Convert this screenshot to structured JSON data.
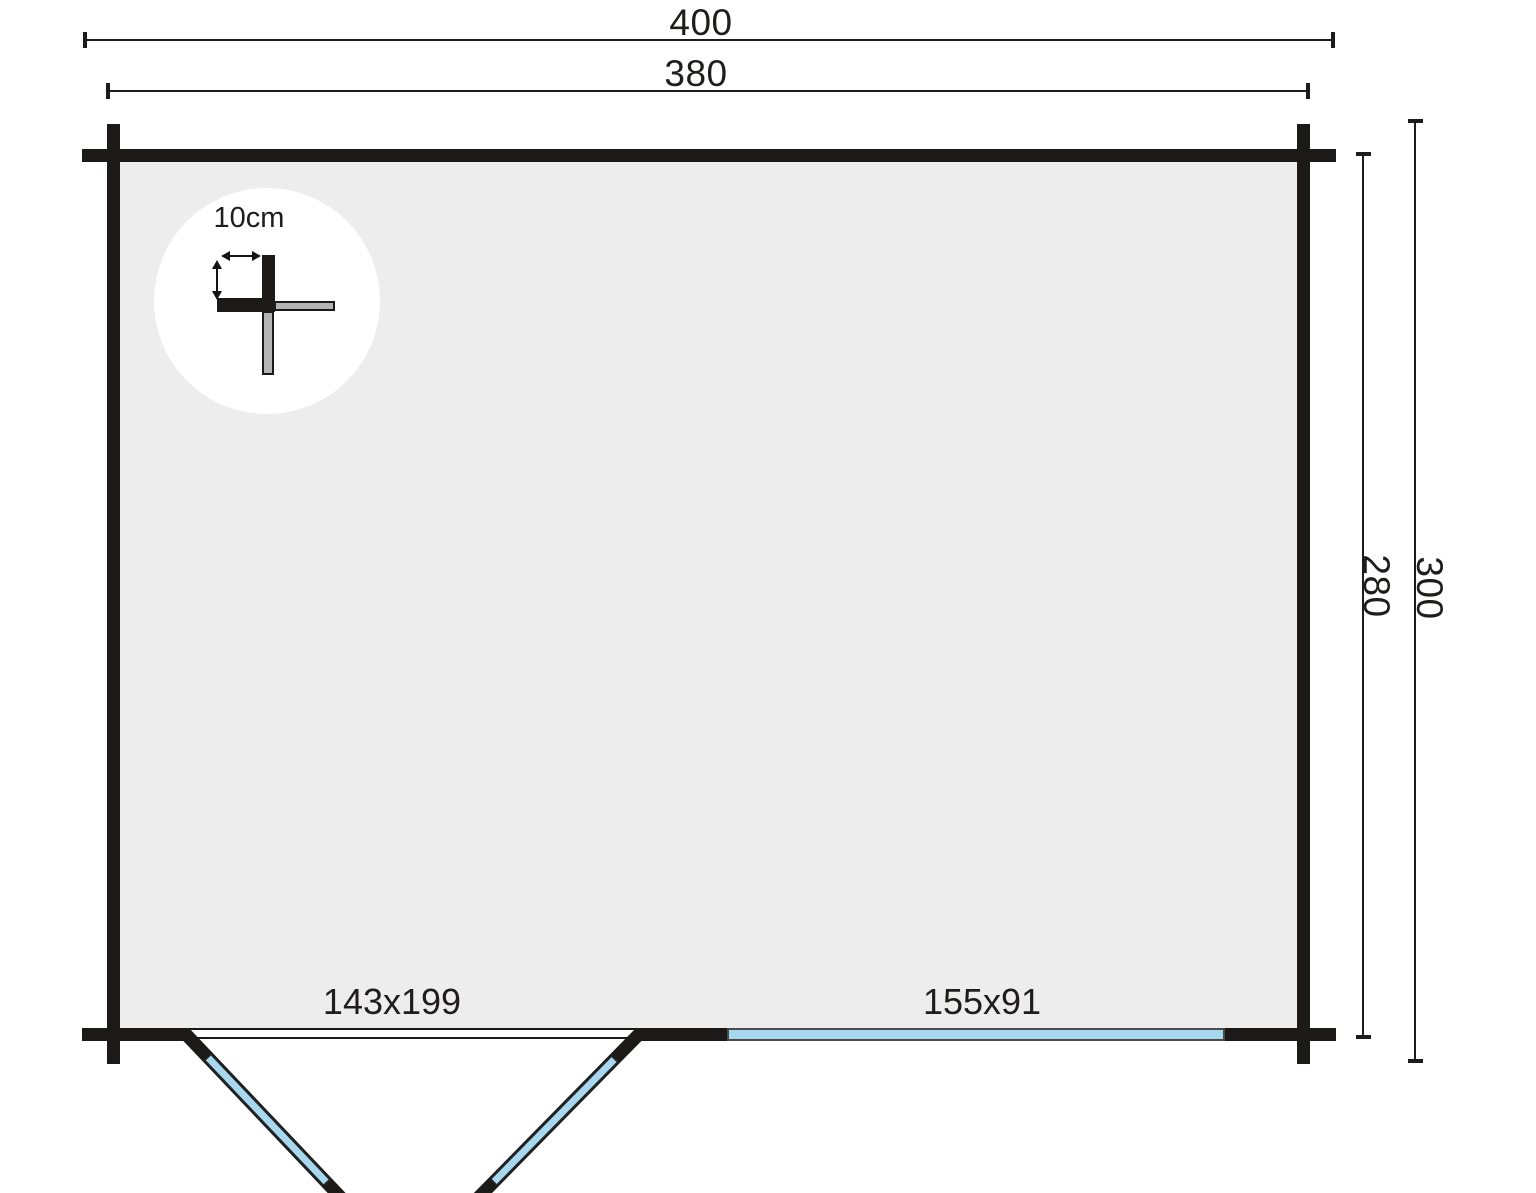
{
  "plan": {
    "type": "log-cabin-floor-plan",
    "dimensions": {
      "overall_width": "400",
      "wall_to_wall_width": "380",
      "overall_depth": "300",
      "wall_to_wall_depth": "280"
    },
    "detail": {
      "wall_thickness": "10cm"
    },
    "door": {
      "label": "143x199"
    },
    "window": {
      "label": "155x91"
    },
    "colors": {
      "wall": "#1b1a18",
      "floor": "#ededed",
      "glazing": "#a7d8f0",
      "background": "#ffffff",
      "dimension_line": "#1c1c1c",
      "detail_gray": "#b4b4b4"
    }
  }
}
